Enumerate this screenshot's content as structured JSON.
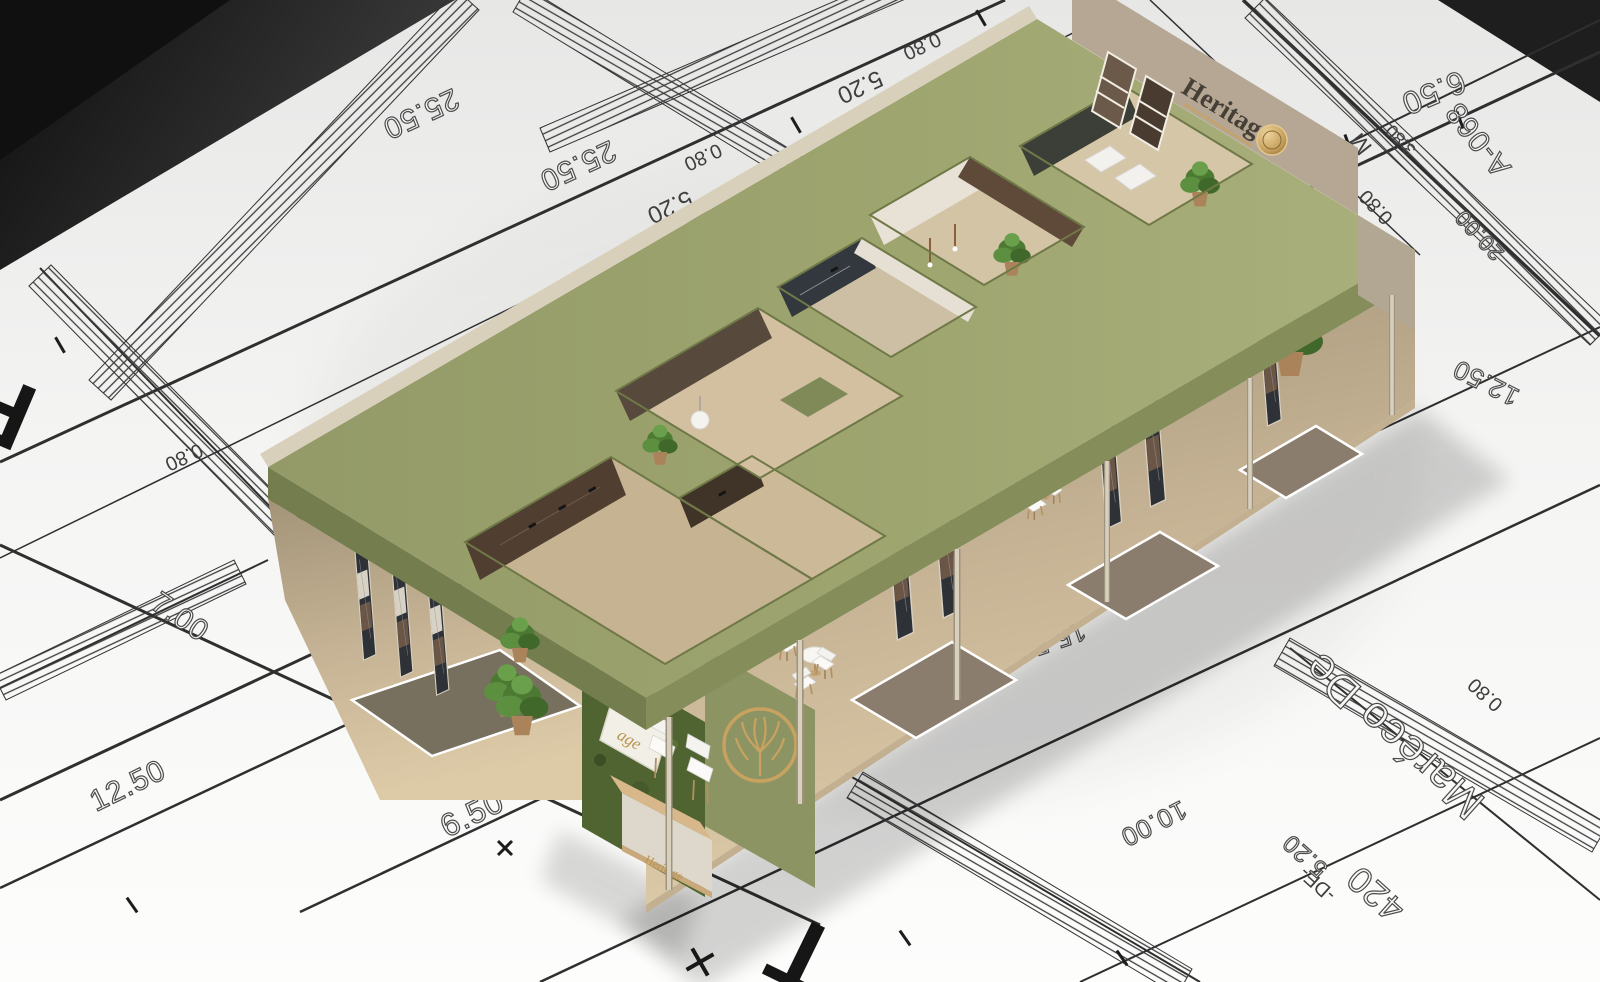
{
  "scene": {
    "description": "3D render of Heritage exhibition stand placed on an architectural blueprint floor plan",
    "colors": {
      "roof_olive": "#9ea56f",
      "wall_beige": "#b5a793",
      "moss_green": "#4f6430",
      "gold": "#c8a25f",
      "wood_floor": "#d7c5a2",
      "blueprint_ink": "#3f3f3f",
      "paper": "#f7f7f5"
    }
  },
  "booth": {
    "brand": "Heritage",
    "back_wall_sign": "Heritage",
    "front_plaque_sign": "age",
    "desk_sign": "Heritage"
  },
  "blueprint": {
    "labels": [
      {
        "text": "25.50"
      },
      {
        "text": "25.50"
      },
      {
        "text": "5.20"
      },
      {
        "text": "5.20"
      },
      {
        "text": "0.80"
      },
      {
        "text": "0.80"
      },
      {
        "text": "0.80"
      },
      {
        "text": "0.80"
      },
      {
        "text": "0.80"
      },
      {
        "text": "6.50"
      },
      {
        "text": "6.50"
      },
      {
        "text": "7.00"
      },
      {
        "text": "12.50"
      },
      {
        "text": "12.50"
      },
      {
        "text": "15.50"
      },
      {
        "text": "10.00"
      },
      {
        "text": "20.00"
      },
      {
        "text": "3.80"
      },
      {
        "text": "A-068"
      },
      {
        "text": "R"
      },
      {
        "text": "T"
      },
      {
        "text": "M"
      },
      {
        "text": "Maréco De"
      },
      {
        "text": "420"
      },
      {
        "text": "-DE-"
      },
      {
        "text": "5.20"
      }
    ]
  }
}
